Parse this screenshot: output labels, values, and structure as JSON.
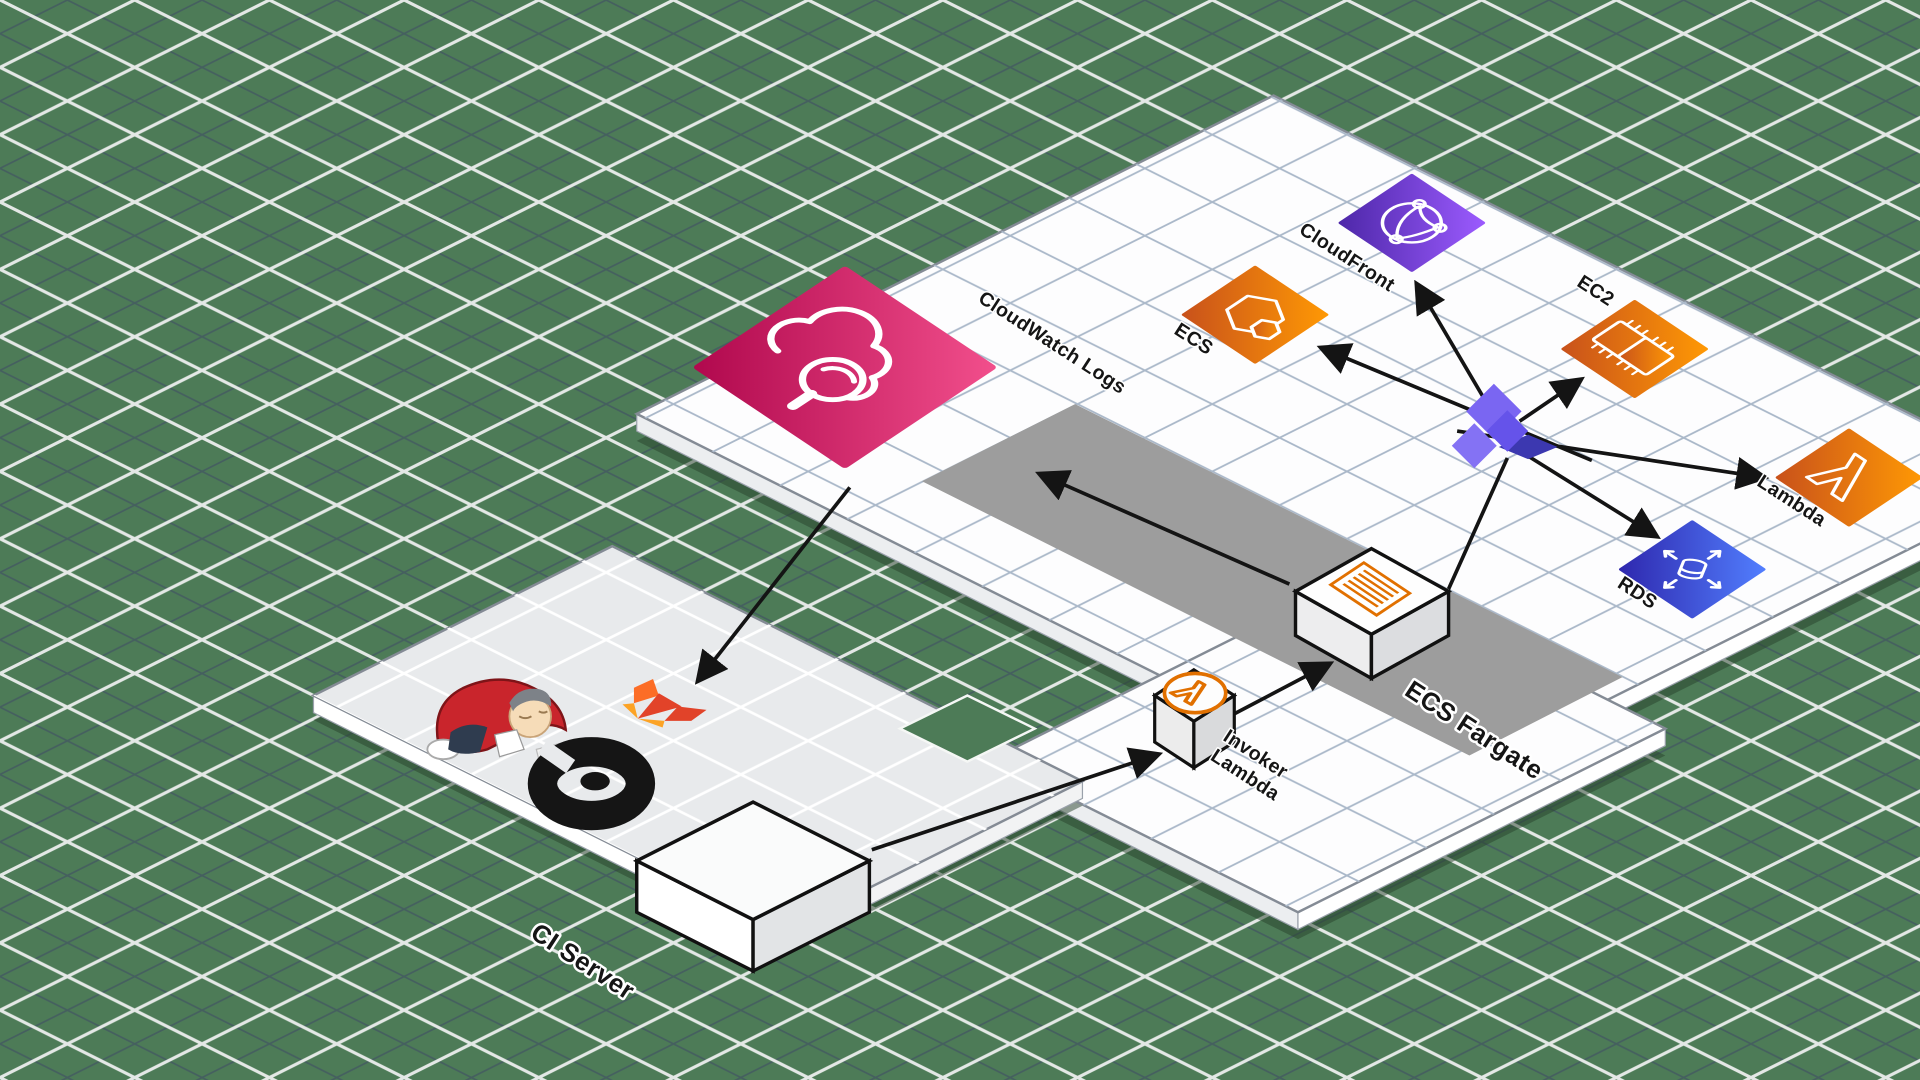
{
  "nodes": {
    "cloudwatch": "CloudWatch Logs",
    "cloudfront": "CloudFront",
    "ecs": "ECS",
    "ec2": "EC2",
    "lambda": "Lambda",
    "rds": "RDS",
    "invoker1": "Invoker",
    "invoker2": "Lambda",
    "fargate": "ECS Fargate",
    "ci": "CI Server"
  },
  "icons": {
    "cloudwatch": "cloud-magnifier-icon",
    "cloudfront": "globe-network-icon",
    "ecs": "container-hexagon-icon",
    "ec2": "cpu-chip-icon",
    "lambda": "lambda-icon",
    "rds": "database-arrows-icon",
    "ci_logos": [
      "jenkins-mascot",
      "gitlab-logo",
      "buddy-logo"
    ],
    "fargate_box": "striped-document-icon",
    "invoker_box": "lambda-badge-icon",
    "hub": "purple-pinwheel-connector"
  },
  "colors": {
    "background_green": "#4d7b57",
    "grid_dark": "#3d4966",
    "grid_white": "#f5f7f5",
    "platform_grid": "#aab8c9",
    "cloudwatch_gradient": [
      "#b0084d",
      "#f24f8c"
    ],
    "orange_gradient": [
      "#c8511b",
      "#ff9904"
    ],
    "cloudfront_gradient": [
      "#4d27a8",
      "#9c5bff"
    ],
    "rds_gradient": [
      "#2e27ad",
      "#527fff"
    ],
    "fargate_zone": "#9d9d9d",
    "hub_purple": "#7a66f2",
    "arrow_black": "#141414",
    "lambda_badge_orange": "#e17000"
  }
}
